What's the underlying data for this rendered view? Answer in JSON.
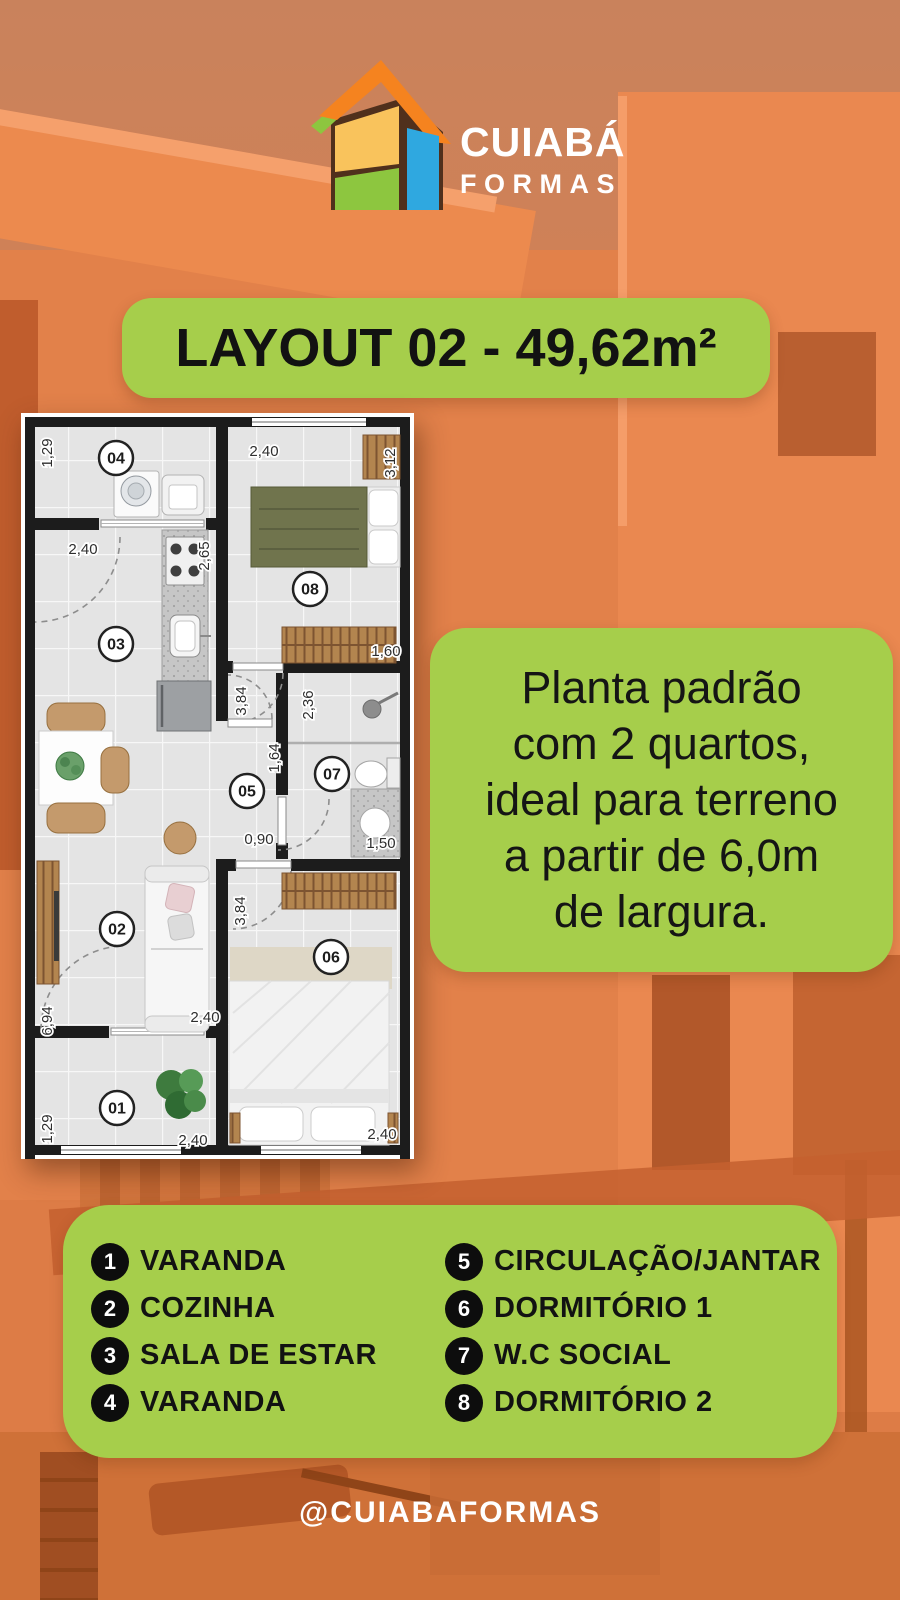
{
  "brand": {
    "line1": "CUIABÁ",
    "line2": "FORMAS"
  },
  "banner": {
    "title": "LAYOUT 02 - 49,62m²"
  },
  "description": {
    "text": "Planta padrão\ncom 2 quartos,\nideal para terreno\na partir de 6,0m\nde largura."
  },
  "floorplan": {
    "rooms": [
      {
        "id": "04",
        "x": 95,
        "y": 45
      },
      {
        "id": "08",
        "x": 289,
        "y": 176
      },
      {
        "id": "03",
        "x": 95,
        "y": 231
      },
      {
        "id": "05",
        "x": 226,
        "y": 378
      },
      {
        "id": "07",
        "x": 311,
        "y": 361
      },
      {
        "id": "02",
        "x": 96,
        "y": 516
      },
      {
        "id": "06",
        "x": 310,
        "y": 544
      },
      {
        "id": "01",
        "x": 96,
        "y": 695
      }
    ],
    "dimensions": [
      {
        "text": "1,29",
        "x": 26,
        "y": 40,
        "vertical": true
      },
      {
        "text": "2,40",
        "x": 62,
        "y": 136,
        "vertical": false
      },
      {
        "text": "2,40",
        "x": 243,
        "y": 38,
        "vertical": false
      },
      {
        "text": "3,12",
        "x": 369,
        "y": 50,
        "vertical": true
      },
      {
        "text": "2,65",
        "x": 183,
        "y": 143,
        "vertical": true
      },
      {
        "text": "1,60",
        "x": 365,
        "y": 238,
        "vertical": false
      },
      {
        "text": "3,84",
        "x": 220,
        "y": 288,
        "vertical": true
      },
      {
        "text": "2,36",
        "x": 287,
        "y": 292,
        "vertical": true
      },
      {
        "text": "1,64",
        "x": 253,
        "y": 345,
        "vertical": true
      },
      {
        "text": "0,90",
        "x": 238,
        "y": 426,
        "vertical": false
      },
      {
        "text": "1,50",
        "x": 360,
        "y": 430,
        "vertical": false
      },
      {
        "text": "6,94",
        "x": 26,
        "y": 608,
        "vertical": true
      },
      {
        "text": "2,40",
        "x": 184,
        "y": 604,
        "vertical": false
      },
      {
        "text": "3,84",
        "x": 219,
        "y": 498,
        "vertical": true
      },
      {
        "text": "1,29",
        "x": 26,
        "y": 716,
        "vertical": true
      },
      {
        "text": "2,40",
        "x": 172,
        "y": 727,
        "vertical": false
      },
      {
        "text": "2,40",
        "x": 361,
        "y": 721,
        "vertical": false
      }
    ]
  },
  "legend": {
    "left": [
      {
        "num": "1",
        "label": "VARANDA"
      },
      {
        "num": "2",
        "label": "COZINHA"
      },
      {
        "num": "3",
        "label": "SALA DE ESTAR"
      },
      {
        "num": "4",
        "label": "VARANDA"
      }
    ],
    "right": [
      {
        "num": "5",
        "label": "CIRCULAÇÃO/JANTAR"
      },
      {
        "num": "6",
        "label": "DORMITÓRIO 1"
      },
      {
        "num": "7",
        "label": "W.C SOCIAL"
      },
      {
        "num": "8",
        "label": "DORMITÓRIO 2"
      }
    ]
  },
  "footer": {
    "handle": "@CUIABAFORMAS"
  },
  "colors": {
    "green": "#a6ce4b",
    "orange": "#dd7c46",
    "text_black": "#121212",
    "white": "#ffffff"
  }
}
